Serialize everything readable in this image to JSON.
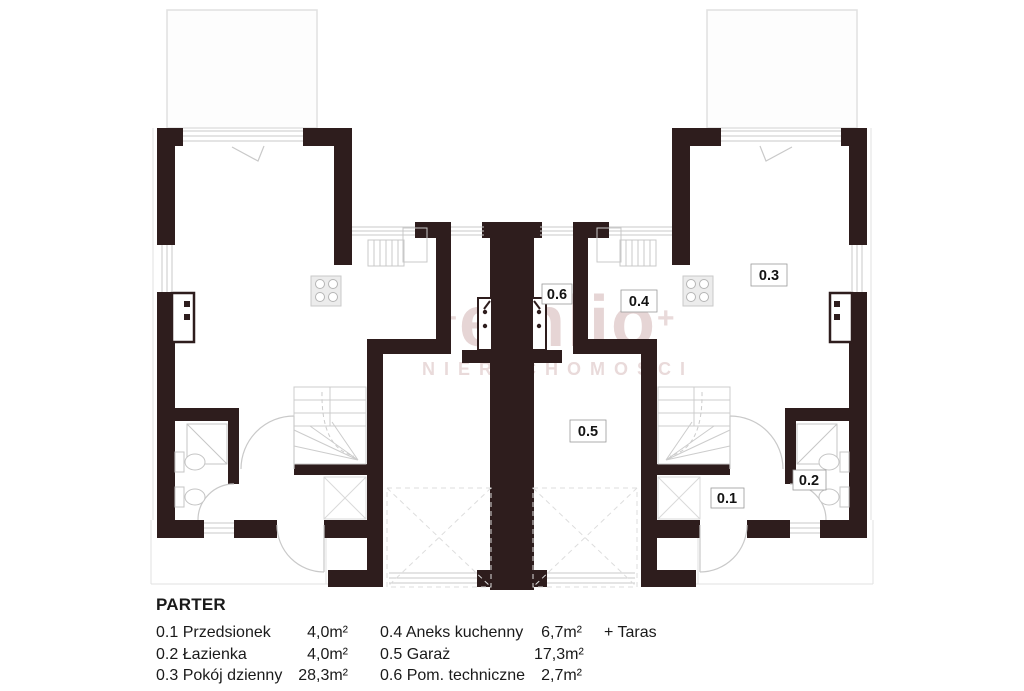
{
  "plan": {
    "floor_title": "PARTER",
    "rooms": [
      {
        "label": "0.1",
        "name": "Przedsionek",
        "area": "4,0m²",
        "extra": ""
      },
      {
        "label": "0.2",
        "name": "Łazienka",
        "area": "4,0m²",
        "extra": ""
      },
      {
        "label": "0.3",
        "name": "Pokój dzienny",
        "area": "28,3m²",
        "extra": ""
      },
      {
        "label": "0.4",
        "name": "Aneks kuchenny",
        "area": "6,7m²",
        "extra": "+ Taras"
      },
      {
        "label": "0.5",
        "name": "Garaż",
        "area": "17,3m²",
        "extra": ""
      },
      {
        "label": "0.6",
        "name": "Pom. techniczne",
        "area": "2,7m²",
        "extra": ""
      }
    ]
  },
  "watermark": {
    "prefix": "+",
    "line1": "emlio",
    "suffix": "+",
    "line2": "NIERUCHOMOŚCI"
  },
  "colors": {
    "wall_dark": "#2E1D1D",
    "wall_gray": "#B2B2B2",
    "fixture_line": "#C9C9C9",
    "outline_line": "#E0E0E0",
    "watermark": "#C9A4A4"
  }
}
